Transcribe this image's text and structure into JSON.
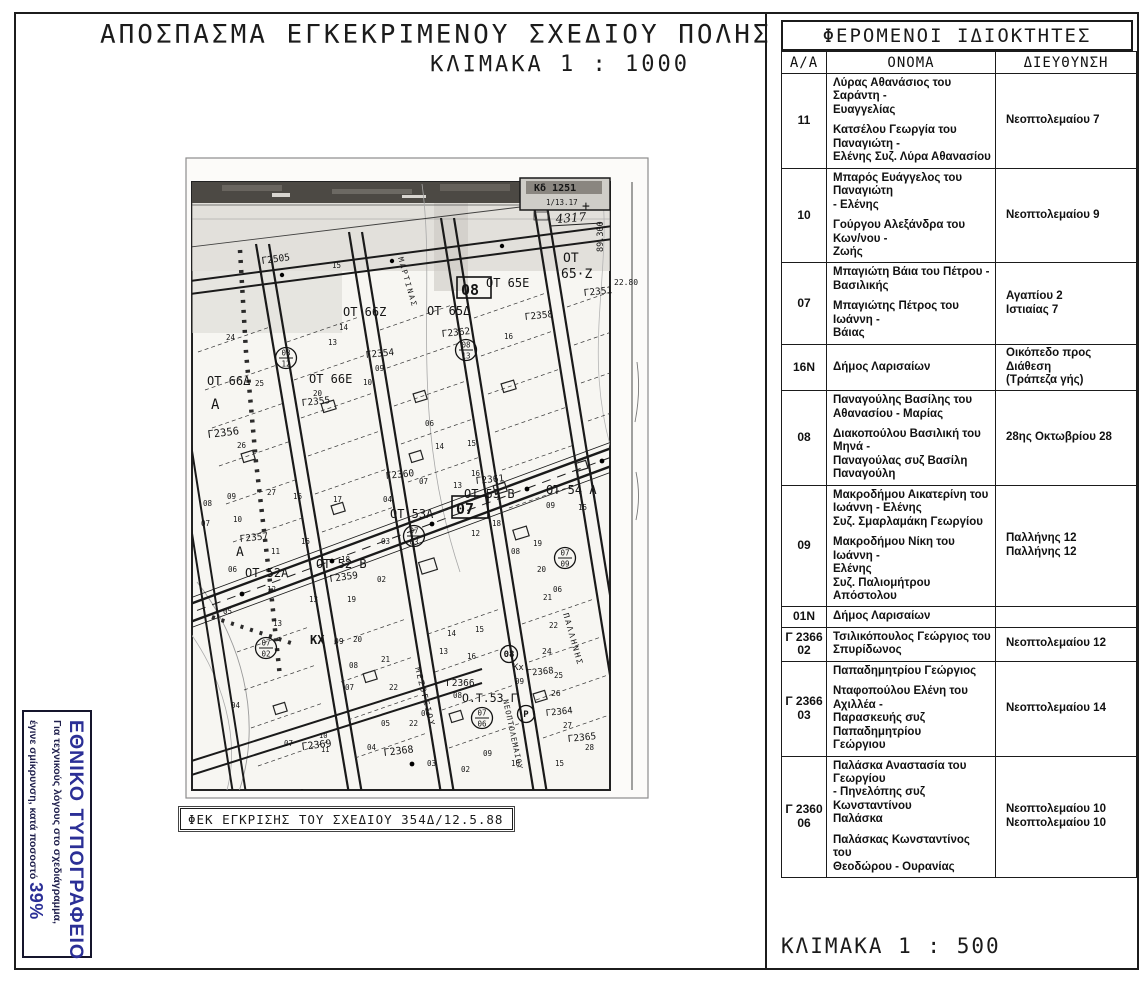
{
  "page": {
    "title": "ΑΠΟΣΠΑΣΜΑ ΕΓΚΕΚΡΙΜΕΝΟΥ ΣΧΕΔΙΟΥ ΠΟΛΗΣ",
    "subtitle": "ΚΛΙΜΑΚΑ  1 : 1000",
    "fek_label": "ΦΕΚ ΕΓΚΡΙΣΗΣ ΤΟΥ ΣΧΕΔΙΟΥ   354Δ/12.5.88",
    "scale_bottom": "ΚΛΙΜΑΚΑ   1 : 500"
  },
  "stamp": {
    "title": "ΕΘΝΙΚΟ ΤΥΠΟΓΡΑΦΕΙΟ",
    "line1": "Για τεχνικούς λόγους στο σχεδιάγραμμα,",
    "line2": "έγινε σμίκρυνση, κατά ποσοστό ",
    "percent": "39%",
    "accent": "#2b2f96"
  },
  "table": {
    "title": "ΦΕΡΟΜΕΝΟΙ ΙΔΙΟΚΤΗΤΕΣ",
    "headers": [
      "Α/Α",
      "ΟΝΟΜΑ",
      "ΔΙΕΥΘΥΝΣΗ"
    ],
    "rows": [
      {
        "aa": "11",
        "names": [
          "Λύρας  Αθανάσιος του Σαράντη -\nΕυαγγελίας",
          "Κατσέλου Γεωργία του Παναγιώτη -\nΕλένης Συζ. Λύρα Αθανασίου"
        ],
        "addresses": [
          "Νεοπτολεμαίου 7"
        ]
      },
      {
        "aa": "10",
        "names": [
          "Μπαρός Ευάγγελος του Παναγιώτη\n- Ελένης",
          "Γούργου Αλεξάνδρα του Κων/νου -\nΖωής"
        ],
        "addresses": [
          "Νεοπτολεμαίου 9"
        ]
      },
      {
        "aa": "07",
        "names": [
          "Μπαγιώτη Βάια του Πέτρου -\nΒασιλικής",
          "Μπαγιώτης Πέτρος του Ιωάννη -\nΒάιας"
        ],
        "addresses": [
          "Αγαπίου 2",
          "Ιστιαίας 7"
        ]
      },
      {
        "aa": "16Ν",
        "names": [
          "Δήμος Λαρισαίων"
        ],
        "addresses": [
          "Οικόπεδο προς Διάθεση\n(Τράπεζα γής)"
        ]
      },
      {
        "aa": "08",
        "names": [
          "Παναγούλης Βασίλης του\nΑθανασίου - Μαρίας",
          "Διακοπούλου Βασιλική του Μηνά -\nΠαναγούλας συζ Βασίλη\nΠαναγούλη"
        ],
        "addresses": [
          "28ης Οκτωβρίου 28"
        ]
      },
      {
        "aa": "09",
        "names": [
          "Μακροδήμου Αικατερίνη του\nΙωάννη - Ελένης\nΣυζ. Σμαρλαμάκη Γεωργίου",
          "Μακροδήμου Νίκη του Ιωάννη -\nΕλένης\nΣυζ. Παλιομήτρου Απόστολου"
        ],
        "addresses": [
          "Παλλήνης 12",
          "Παλλήνης 12"
        ]
      },
      {
        "aa": "01Ν",
        "names": [
          "Δήμος Λαρισαίων"
        ],
        "addresses": [
          ""
        ]
      },
      {
        "aa": "Γ 2366\n02",
        "names": [
          "Τσιλικόπουλος Γεώργιος του\nΣπυρίδωνος"
        ],
        "addresses": [
          "Νεοπτολεμαίου 12"
        ]
      },
      {
        "aa": "Γ 2366\n03",
        "names": [
          "Παπαδημητρίου Γεώργιος",
          "Νταφοπούλου Ελένη του Αχιλλέα -\nΠαρασκευής συζ Παπαδημητρίου\nΓεώργιου"
        ],
        "addresses": [
          "Νεοπτολεμαίου 14"
        ]
      },
      {
        "aa": "Γ 2360\n06",
        "names": [
          "Παλάσκα Αναστασία του Γεωργίου\n- Πηνελόπης συζ Κωνσταντίνου\nΠαλάσκα",
          "Παλάσκας Κωνσταντίνος του\nΘεοδώρου - Ουρανίας"
        ],
        "addresses": [
          "Νεοπτολεμαίου 10",
          "Νεοπτολεμαίου 10"
        ]
      }
    ]
  },
  "map": {
    "labels": [
      {
        "t": "Κδ 1251",
        "x": 352,
        "y": 39,
        "s": 10,
        "w": "b"
      },
      {
        "t": "1/13.17",
        "x": 364,
        "y": 53,
        "s": 7.5
      },
      {
        "t": "4317",
        "x": 374,
        "y": 71,
        "s": 12,
        "hand": true
      },
      {
        "t": "+",
        "x": 400,
        "y": 58,
        "s": 13
      },
      {
        "t": "89.300",
        "x": 421,
        "y": 100,
        "s": 8.5,
        "r": -90
      },
      {
        "t": "22.80",
        "x": 432,
        "y": 133,
        "s": 8
      },
      {
        "t": "ΟΤ",
        "x": 381,
        "y": 110,
        "s": 13
      },
      {
        "t": "65·Ζ",
        "x": 379,
        "y": 126,
        "s": 13
      },
      {
        "t": "ΟΤ 65Ε",
        "x": 304,
        "y": 135,
        "s": 12
      },
      {
        "t": "Γ2351",
        "x": 402,
        "y": 144,
        "s": 9.5,
        "r": -6
      },
      {
        "k": "b",
        "t": "08",
        "x": 279,
        "y": 143,
        "s": 15,
        "bw": 34,
        "bh": 21
      },
      {
        "t": "ΟΤ 65Δ",
        "x": 245,
        "y": 163,
        "s": 12
      },
      {
        "t": "Γ2358",
        "x": 343,
        "y": 168,
        "s": 9.5,
        "r": -6
      },
      {
        "t": "16",
        "x": 322,
        "y": 187,
        "s": 7.5
      },
      {
        "t": "ΟΤ 66Ζ",
        "x": 161,
        "y": 164,
        "s": 12
      },
      {
        "t": "14",
        "x": 157,
        "y": 178,
        "s": 7.5
      },
      {
        "t": "15",
        "x": 150,
        "y": 116,
        "s": 7.5
      },
      {
        "t": "13",
        "x": 146,
        "y": 193,
        "s": 7.5
      },
      {
        "t": "ΜΑΡΤΙΝΑΣ",
        "x": 216,
        "y": 106,
        "s": 7.5,
        "r": 74,
        "sp": 2
      },
      {
        "t": "Γ2505",
        "x": 80,
        "y": 112,
        "s": 9.5,
        "r": -8
      },
      {
        "t": "24",
        "x": 44,
        "y": 188,
        "s": 7.5
      },
      {
        "t": "ΟΤ 66Δ",
        "x": 25,
        "y": 233,
        "s": 12
      },
      {
        "t": "25",
        "x": 73,
        "y": 234,
        "s": 7.5
      },
      {
        "t": "Α",
        "x": 29,
        "y": 257,
        "s": 14
      },
      {
        "t": "26",
        "x": 55,
        "y": 296,
        "s": 7.5
      },
      {
        "t": "27",
        "x": 85,
        "y": 343,
        "s": 7.5
      },
      {
        "k": "c",
        "top": "08",
        "bot": "12",
        "x": 104,
        "y": 206
      },
      {
        "t": "ΟΤ 66Ε",
        "x": 127,
        "y": 231,
        "s": 12
      },
      {
        "t": "20",
        "x": 131,
        "y": 244,
        "s": 7.5
      },
      {
        "t": "Γ2355",
        "x": 120,
        "y": 254,
        "s": 9.5,
        "r": -6
      },
      {
        "t": "Γ2354",
        "x": 184,
        "y": 206,
        "s": 9.5,
        "r": -6
      },
      {
        "t": "09",
        "x": 193,
        "y": 219,
        "s": 7.5
      },
      {
        "t": "10",
        "x": 181,
        "y": 233,
        "s": 7.5
      },
      {
        "t": "Γ2362",
        "x": 260,
        "y": 185,
        "s": 9.5,
        "r": -6
      },
      {
        "k": "c",
        "top": "08",
        "bot": "13",
        "x": 284,
        "y": 198
      },
      {
        "t": "Γ2356",
        "x": 26,
        "y": 286,
        "s": 10.5,
        "r": -7
      },
      {
        "t": "Γ2357",
        "x": 58,
        "y": 390,
        "s": 9.5,
        "r": -6
      },
      {
        "t": "Α",
        "x": 54,
        "y": 404,
        "s": 13
      },
      {
        "t": "ΟΤ 52Α",
        "x": 63,
        "y": 425,
        "s": 12
      },
      {
        "t": "06",
        "x": 46,
        "y": 420,
        "s": 7.5
      },
      {
        "t": "05",
        "x": 41,
        "y": 462,
        "s": 7.5
      },
      {
        "t": "04",
        "x": 49,
        "y": 556,
        "s": 7.5
      },
      {
        "t": "08",
        "x": 21,
        "y": 354,
        "s": 7.5
      },
      {
        "t": "09",
        "x": 45,
        "y": 347,
        "s": 7.5
      },
      {
        "t": "10",
        "x": 51,
        "y": 370,
        "s": 7.5
      },
      {
        "t": "07",
        "x": 19,
        "y": 374,
        "s": 7.5
      },
      {
        "t": "11",
        "x": 89,
        "y": 402,
        "s": 7.5
      },
      {
        "t": "12",
        "x": 85,
        "y": 440,
        "s": 7.5
      },
      {
        "t": "13",
        "x": 91,
        "y": 474,
        "s": 7.5
      },
      {
        "t": "16",
        "x": 111,
        "y": 347,
        "s": 7.5
      },
      {
        "t": "17",
        "x": 151,
        "y": 350,
        "s": 7.5
      },
      {
        "t": "15",
        "x": 119,
        "y": 392,
        "s": 7.5
      },
      {
        "t": "18",
        "x": 159,
        "y": 410,
        "s": 7.5
      },
      {
        "t": "13",
        "x": 127,
        "y": 450,
        "s": 7.5
      },
      {
        "t": "19",
        "x": 165,
        "y": 450,
        "s": 7.5
      },
      {
        "t": "ΟΤ 52 Β",
        "x": 134,
        "y": 416,
        "s": 12
      },
      {
        "t": "Γ2359",
        "x": 148,
        "y": 430,
        "s": 9.5,
        "r": -8
      },
      {
        "t": "20",
        "x": 171,
        "y": 490,
        "s": 7.5
      },
      {
        "t": "ΟΤ 53Α",
        "x": 208,
        "y": 366,
        "s": 12
      },
      {
        "k": "c",
        "top": "07",
        "bot": "03",
        "x": 232,
        "y": 384
      },
      {
        "t": "04",
        "x": 201,
        "y": 350,
        "s": 7.5
      },
      {
        "t": "03",
        "x": 199,
        "y": 392,
        "s": 7.5
      },
      {
        "t": "02",
        "x": 195,
        "y": 430,
        "s": 7.5
      },
      {
        "t": "07",
        "x": 237,
        "y": 332,
        "s": 7.5
      },
      {
        "t": "06",
        "x": 243,
        "y": 274,
        "s": 7.5
      },
      {
        "t": "Γ2360",
        "x": 204,
        "y": 327,
        "s": 9.5,
        "r": -6
      },
      {
        "t": "14",
        "x": 253,
        "y": 297,
        "s": 7.5
      },
      {
        "t": "15",
        "x": 285,
        "y": 294,
        "s": 7.5
      },
      {
        "t": "16",
        "x": 289,
        "y": 324,
        "s": 7.5
      },
      {
        "t": "13",
        "x": 271,
        "y": 336,
        "s": 7.5
      },
      {
        "t": "Γ2361",
        "x": 294,
        "y": 332,
        "s": 9.5,
        "r": -6
      },
      {
        "t": "ΟΤ 53 Β",
        "x": 282,
        "y": 346,
        "s": 12
      },
      {
        "k": "b",
        "t": "07",
        "x": 274,
        "y": 362,
        "s": 15,
        "bw": 36,
        "bh": 22
      },
      {
        "t": "18",
        "x": 310,
        "y": 374,
        "s": 7.5
      },
      {
        "t": "12",
        "x": 289,
        "y": 384,
        "s": 7.5
      },
      {
        "t": "ΟΤ 54 Α",
        "x": 364,
        "y": 342,
        "s": 12
      },
      {
        "t": "09",
        "x": 364,
        "y": 356,
        "s": 7.5
      },
      {
        "t": "15",
        "x": 396,
        "y": 358,
        "s": 7.5
      },
      {
        "t": "08",
        "x": 329,
        "y": 402,
        "s": 7.5
      },
      {
        "t": "19",
        "x": 351,
        "y": 394,
        "s": 7.5
      },
      {
        "k": "c",
        "top": "07",
        "bot": "09",
        "x": 383,
        "y": 406
      },
      {
        "t": "20",
        "x": 355,
        "y": 420,
        "s": 7.5
      },
      {
        "t": "06",
        "x": 371,
        "y": 440,
        "s": 7.5
      },
      {
        "t": "21",
        "x": 361,
        "y": 448,
        "s": 7.5
      },
      {
        "t": "22",
        "x": 367,
        "y": 476,
        "s": 7.5
      },
      {
        "k": "c",
        "top": "07",
        "bot": "02",
        "x": 84,
        "y": 496
      },
      {
        "t": "ΚΧ",
        "x": 128,
        "y": 492,
        "s": 12,
        "w": "b"
      },
      {
        "t": "09",
        "x": 152,
        "y": 492,
        "s": 8
      },
      {
        "t": "21",
        "x": 199,
        "y": 510,
        "s": 7.5
      },
      {
        "t": "08",
        "x": 167,
        "y": 516,
        "s": 7.5
      },
      {
        "t": "07",
        "x": 163,
        "y": 538,
        "s": 7.5
      },
      {
        "t": "22",
        "x": 207,
        "y": 538,
        "s": 7.5
      },
      {
        "t": "14",
        "x": 265,
        "y": 484,
        "s": 7.5
      },
      {
        "t": "15",
        "x": 293,
        "y": 480,
        "s": 7.5
      },
      {
        "t": "16",
        "x": 285,
        "y": 507,
        "s": 7.5
      },
      {
        "t": "13",
        "x": 257,
        "y": 502,
        "s": 7.5
      },
      {
        "t": "05",
        "x": 199,
        "y": 574,
        "s": 7.5
      },
      {
        "t": "06",
        "x": 239,
        "y": 564,
        "s": 7.5
      },
      {
        "t": "Γ2369",
        "x": 120,
        "y": 598,
        "s": 10,
        "r": -7
      },
      {
        "t": "07",
        "x": 102,
        "y": 594,
        "s": 7.5
      },
      {
        "t": "10",
        "x": 137,
        "y": 586,
        "s": 7
      },
      {
        "t": "11",
        "x": 139,
        "y": 600,
        "s": 7
      },
      {
        "t": "Γ2368",
        "x": 202,
        "y": 604,
        "s": 10,
        "r": -7
      },
      {
        "t": "04",
        "x": 185,
        "y": 598,
        "s": 7.5
      },
      {
        "t": "22",
        "x": 227,
        "y": 574,
        "s": 7.5
      },
      {
        "t": "03",
        "x": 245,
        "y": 614,
        "s": 7.5
      },
      {
        "t": "02",
        "x": 279,
        "y": 620,
        "s": 7.5
      },
      {
        "t": "ΜΕΣΟΓΕΙΟΥ",
        "x": 233,
        "y": 516,
        "s": 8,
        "r": 76,
        "sp": 2
      },
      {
        "t": "Γ2366",
        "x": 264,
        "y": 534,
        "s": 9.5
      },
      {
        "t": "08",
        "x": 271,
        "y": 546,
        "s": 7.5
      },
      {
        "t": "Ο.Τ.53 Γ",
        "x": 280,
        "y": 550,
        "s": 11.5
      },
      {
        "k": "c",
        "top": "07",
        "bot": "06",
        "x": 300,
        "y": 566
      },
      {
        "t": "09",
        "x": 301,
        "y": 604,
        "s": 7.5
      },
      {
        "t": "ΝΕΟΠΤΟΛΕΜΑΙΟΥ",
        "x": 321,
        "y": 548,
        "s": 7.5,
        "r": 78,
        "sp": 1
      },
      {
        "k": "c1",
        "t": "08",
        "x": 327,
        "y": 502
      },
      {
        "t": "Κx.",
        "x": 331,
        "y": 518,
        "s": 9
      },
      {
        "t": "09",
        "x": 333,
        "y": 532,
        "s": 7.5
      },
      {
        "t": "Γ2368",
        "x": 345,
        "y": 524,
        "s": 9,
        "r": -6
      },
      {
        "t": "25",
        "x": 372,
        "y": 526,
        "s": 7.5
      },
      {
        "t": "24",
        "x": 360,
        "y": 502,
        "s": 8
      },
      {
        "t": "26",
        "x": 369,
        "y": 544,
        "s": 8
      },
      {
        "k": "c1",
        "t": "Ρ",
        "x": 344,
        "y": 562
      },
      {
        "t": "Γ2364",
        "x": 364,
        "y": 564,
        "s": 9,
        "r": -6
      },
      {
        "t": "27",
        "x": 381,
        "y": 576,
        "s": 7.5
      },
      {
        "t": "Γ2365",
        "x": 386,
        "y": 590,
        "s": 9.5,
        "r": -6
      },
      {
        "t": "28",
        "x": 403,
        "y": 598,
        "s": 7.5
      },
      {
        "t": "ΠΑΛΛΗΝΗΣ",
        "x": 381,
        "y": 462,
        "s": 8,
        "r": 74,
        "sp": 2
      },
      {
        "t": "10",
        "x": 329,
        "y": 614,
        "s": 7.5
      },
      {
        "t": "15",
        "x": 373,
        "y": 614,
        "s": 7.5
      }
    ]
  }
}
